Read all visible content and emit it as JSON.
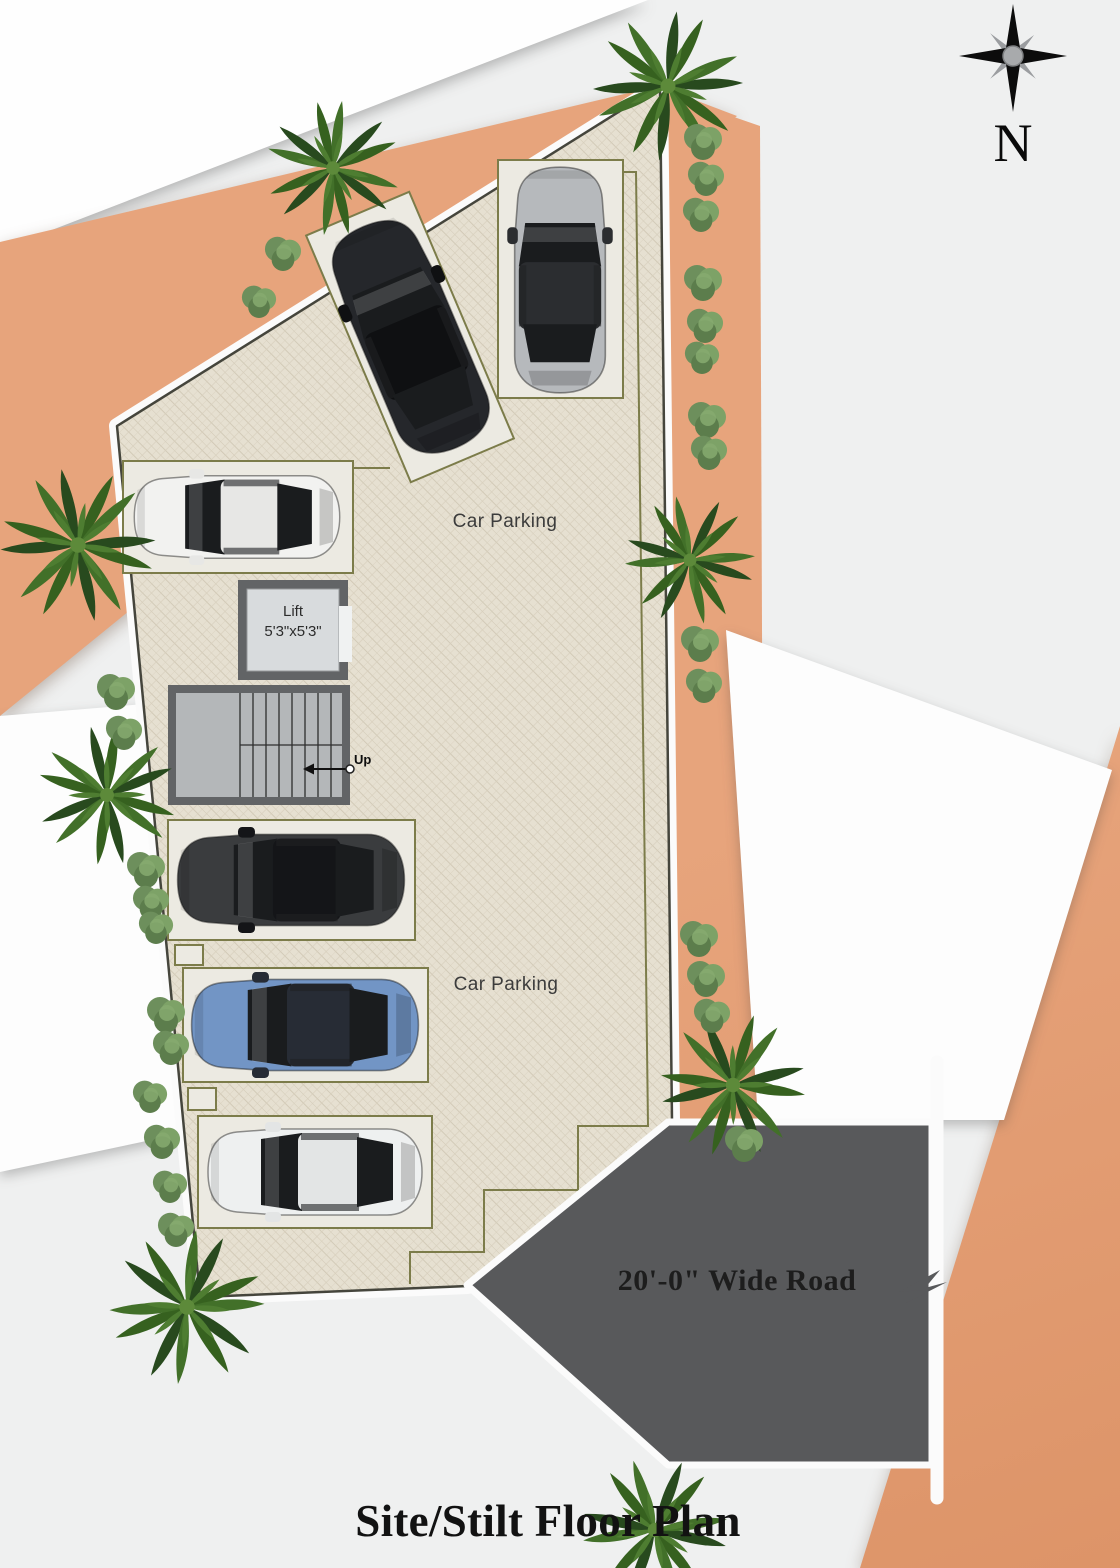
{
  "page": {
    "title": "Site/Stilt Floor Plan"
  },
  "compass": {
    "label": "N",
    "icon": "compass-rose-icon"
  },
  "plan": {
    "areas": [
      {
        "label": "Car Parking"
      },
      {
        "label": "Car Parking"
      }
    ],
    "lift": {
      "label": "Lift",
      "dimensions": "5'3\"x5'3\""
    },
    "stairs": {
      "label": "Up",
      "icon": "up-arrow-icon"
    },
    "road": {
      "label": "20'-0\" Wide Road"
    }
  },
  "cars": [
    {
      "name": "black-suv-angled",
      "body": "#25272b",
      "roof": "#0f1012"
    },
    {
      "name": "silver-hatchback",
      "body": "#b6b9bc",
      "roof": "#2b2d30"
    },
    {
      "name": "white-sedan",
      "body": "#f2f2f0",
      "roof": "#e7e7e5"
    },
    {
      "name": "dark-gray-sedan",
      "body": "#3a3c3e",
      "roof": "#141518"
    },
    {
      "name": "blue-hatchback",
      "body": "#7295c5",
      "roof": "#272c35"
    },
    {
      "name": "white-sedan-bottom",
      "body": "#eef0f0",
      "roof": "#e3e5e5"
    }
  ],
  "colors": {
    "road": "#58595b",
    "peach": "#e7a47c",
    "paving": "#e6e0d1",
    "bay_outline": "#7c7c4a",
    "structure_gray": "#626466"
  }
}
